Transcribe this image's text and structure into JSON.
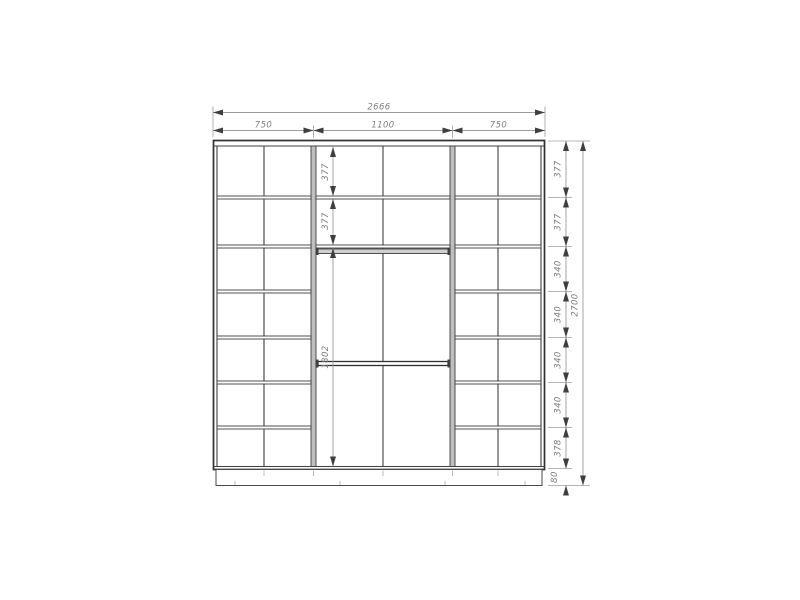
{
  "dimensions": {
    "overall_width": "2666",
    "section_widths": [
      "750",
      "1100",
      "750"
    ],
    "overall_height": "2700",
    "right_chain": [
      "377",
      "377",
      "340",
      "340",
      "340",
      "340",
      "378",
      "80"
    ],
    "middle_chain": [
      "377",
      "377"
    ],
    "hanging_height": "1802"
  },
  "colors": {
    "object_line": "#3f3f3f",
    "dimension_line": "#9c9c9c",
    "label_text": "#7d7d7d",
    "background": "#ffffff"
  }
}
